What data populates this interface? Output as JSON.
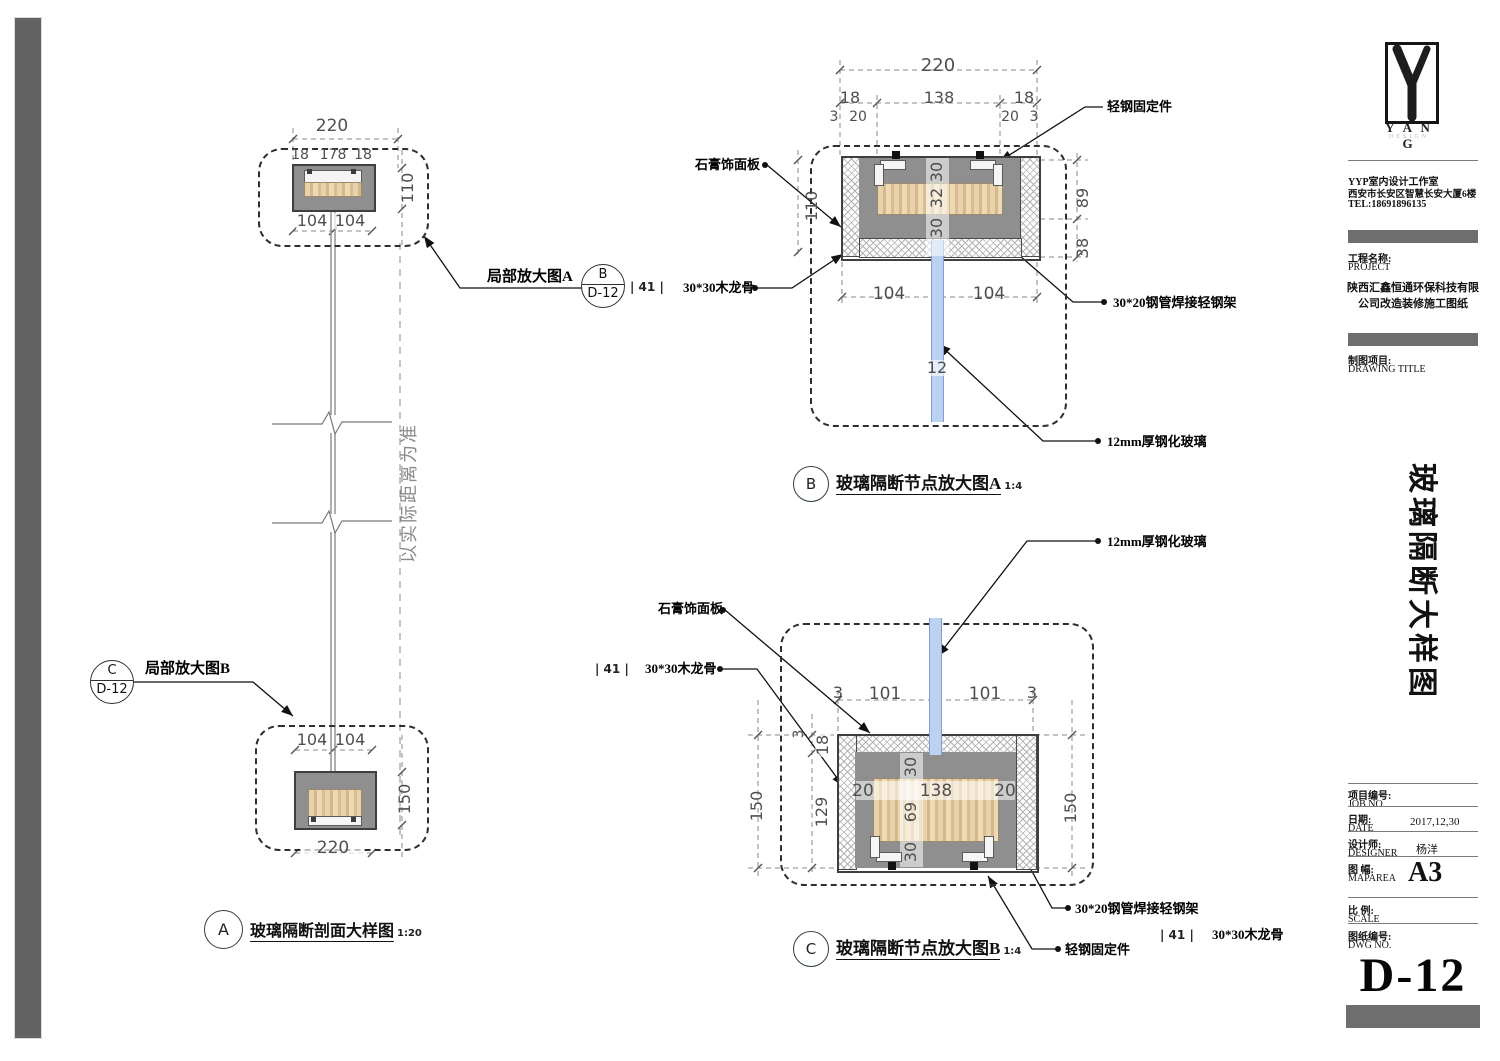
{
  "a": {
    "dim220_top": "220",
    "dim18l": "18",
    "dim178": "178",
    "dim18r": "18",
    "dim110": "110",
    "dim104a": "104",
    "dim104b": "104",
    "note_vertical": "以实际距离为准",
    "callout_top": {
      "label": "局部放大图A",
      "bubble_letter": "B",
      "bubble_ref": "D-12",
      "marker": "| 41 |"
    },
    "callout_bottom": {
      "label": "局部放大图B",
      "bubble_letter": "C",
      "bubble_ref": "D-12"
    },
    "dim104c": "104",
    "dim104d": "104",
    "dim150": "150",
    "dim220_bottom": "220",
    "title": {
      "letter": "A",
      "text": "玻璃隔断剖面大样图",
      "scale": "1:20"
    }
  },
  "b": {
    "dim220": "220",
    "dim18l": "18",
    "dim138": "138",
    "dim18r": "18",
    "dim3l": "3",
    "dim20l": "20",
    "dim20r": "20",
    "dim3r": "3",
    "dim110": "110",
    "dim89": "89",
    "dim38": "38",
    "dim30t": "30",
    "dim32": "32",
    "dim30b": "30",
    "dim104l": "104",
    "dim104r": "104",
    "dim12": "12",
    "labels": {
      "fixing": "轻钢固定件",
      "gypsum": "石膏饰面板",
      "joist": "30*30木龙骨",
      "frame": "30*20钢管焊接轻钢架",
      "glass": "12mm厚钢化玻璃"
    },
    "title": {
      "letter": "B",
      "text": "玻璃隔断节点放大图A",
      "scale": "1:4"
    }
  },
  "c": {
    "dim3l": "3",
    "dim101l": "101",
    "dim101r": "101",
    "dim3r": "3",
    "dim3side": "3",
    "dim18": "18",
    "dim129": "129",
    "dim150l": "150",
    "dim150r": "150",
    "dim30t": "30",
    "dim69": "69",
    "dim30b": "30",
    "dim20l": "20",
    "dim138": "138",
    "dim20r": "20",
    "labels": {
      "glass": "12mm厚钢化玻璃",
      "gypsum": "石膏饰面板",
      "marker_l": "| 41 |",
      "joist_l": "30*30木龙骨",
      "frame": "30*20钢管焊接轻钢架",
      "fixing": "轻钢固定件",
      "marker_r": "| 41 |",
      "joist_r": "30*30木龙骨"
    },
    "title": {
      "letter": "C",
      "text": "玻璃隔断节点放大图B",
      "scale": "1:4"
    }
  },
  "titleblock": {
    "logo": {
      "text": "Y A N G",
      "sub": "DESIGN"
    },
    "studio": {
      "line1": "YYP室内设计工作室",
      "line2": "西安市长安区智慧长安大厦6楼",
      "line3": "TEL:18691896135"
    },
    "project": {
      "label": "工程名称:",
      "label_en": "PROJECT",
      "name1": "陕西汇鑫恒通环保科技有限",
      "name2": "公司改造装修施工图纸"
    },
    "drawing": {
      "label": "制图项目:",
      "label_en": "DRAWING TITLE",
      "vertical_title": "玻璃隔断大样图"
    },
    "rows": {
      "job": {
        "label": "项目编号:",
        "label_en": "JOB NO."
      },
      "date": {
        "label": "日期:",
        "label_en": "DATE",
        "value": "2017,12,30"
      },
      "designer": {
        "label": "设计师:",
        "label_en": "DESIGNER",
        "value": "杨洋"
      },
      "maparea": {
        "label": "图 幅:",
        "label_en": "MAPAREA",
        "value": "A3"
      },
      "scale": {
        "label": "比 例:",
        "label_en": "SCALE"
      },
      "dwg": {
        "label": "图纸编号:",
        "label_en": "DWG NO.",
        "value": "D-12"
      }
    }
  }
}
